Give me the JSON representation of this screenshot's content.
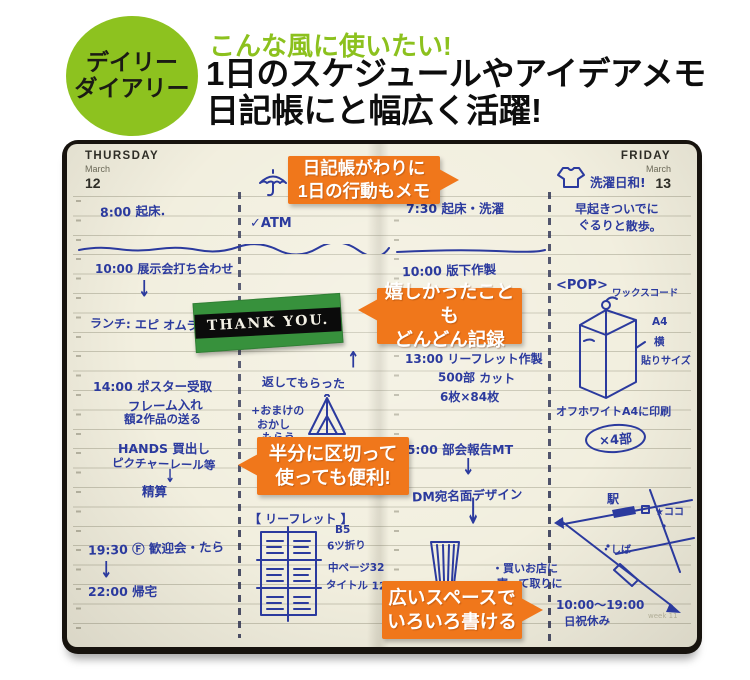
{
  "colors": {
    "badge_green": "#8dc21f",
    "accent_orange": "#f0771b",
    "ink_blue": "#2b3a9e",
    "sticker_green": "#37913c",
    "paper": "#f2efdf"
  },
  "badge": {
    "line1": "デイリー",
    "line2": "ダイアリー"
  },
  "heading": {
    "eyebrow": "こんな風に使いたい!",
    "line1": "1日のスケジュールやアイデアメモ",
    "line2": "日記帳にと幅広く活躍!"
  },
  "pages": {
    "left": {
      "day": "THURSDAY",
      "month": "March",
      "date": "12"
    },
    "right": {
      "day": "FRIDAY",
      "month": "March",
      "date": "13"
    }
  },
  "callouts": [
    {
      "line1": "日記帳がわりに",
      "line2": "1日の行動もメモ"
    },
    {
      "line1": "嬉しかったことも",
      "line2": "どんどん記録"
    },
    {
      "line1": "半分に区切って",
      "line2": "使っても便利!"
    },
    {
      "line1": "広いスペースで",
      "line2": "いろいろ書ける"
    }
  ],
  "sticker": {
    "text": "THANK YOU."
  },
  "notes": {
    "thu": {
      "wake": "8:00 起床.",
      "expo": "10:00 展示会打ち合わせ",
      "arrow_a": "↓",
      "lunch": "ランチ: エピ オムライス!",
      "poster": "14:00 ポスター受取",
      "frame": "フレーム入れ",
      "works": "額2作品の送る",
      "hands": "HANDS 買出し",
      "rail": "ピクチャーレール等",
      "arrow_b": "↓",
      "seisan": "精算",
      "party": "19:30 Ⓕ 歓迎会・たら",
      "arrow_c": "↓",
      "home": "22:00 帰宅"
    },
    "thu2": {
      "atm": "✓ATM",
      "arrow_up": "↑",
      "returned": "返してもらった",
      "omake1": "+おまけの",
      "omake2": "おかし",
      "omake3": "もらう",
      "leaflet": "【 リーフレット 】",
      "b5": "B5",
      "fold": "6ツ折り",
      "naka": "中ページ32",
      "title": "タイトル 12p"
    },
    "fri": {
      "wake": "7:30 起床・洗濯",
      "hanshita": "10:00 版下作製",
      "leaflet": "13:00 リーフレット作製",
      "cut": "500部 カット",
      "maisu": "6枚×84枚",
      "mt": "15:00 部会報告MT",
      "arrow_a": "↓",
      "dm": "DM宛名面デザイン",
      "arrow_b": "↓",
      "shop1": "・買いお店に",
      "shop2": "寄って取りに"
    },
    "fri2": {
      "walk1": "早起きついでに",
      "walk2": "ぐるりと散歩。",
      "laundry": "洗濯日和!",
      "pop": "<POP>",
      "wax": "ワックスコード",
      "a4": "A4",
      "yoko": "横",
      "size": "貼りサイズ",
      "print": "オフホワイトA4に印刷",
      "x4": "×4部",
      "eki": "駅",
      "koko": "★ココ",
      "shiba": "・しば",
      "hours": "10:00〜19:00",
      "closed": "日祝休み",
      "week": "week 11"
    }
  }
}
